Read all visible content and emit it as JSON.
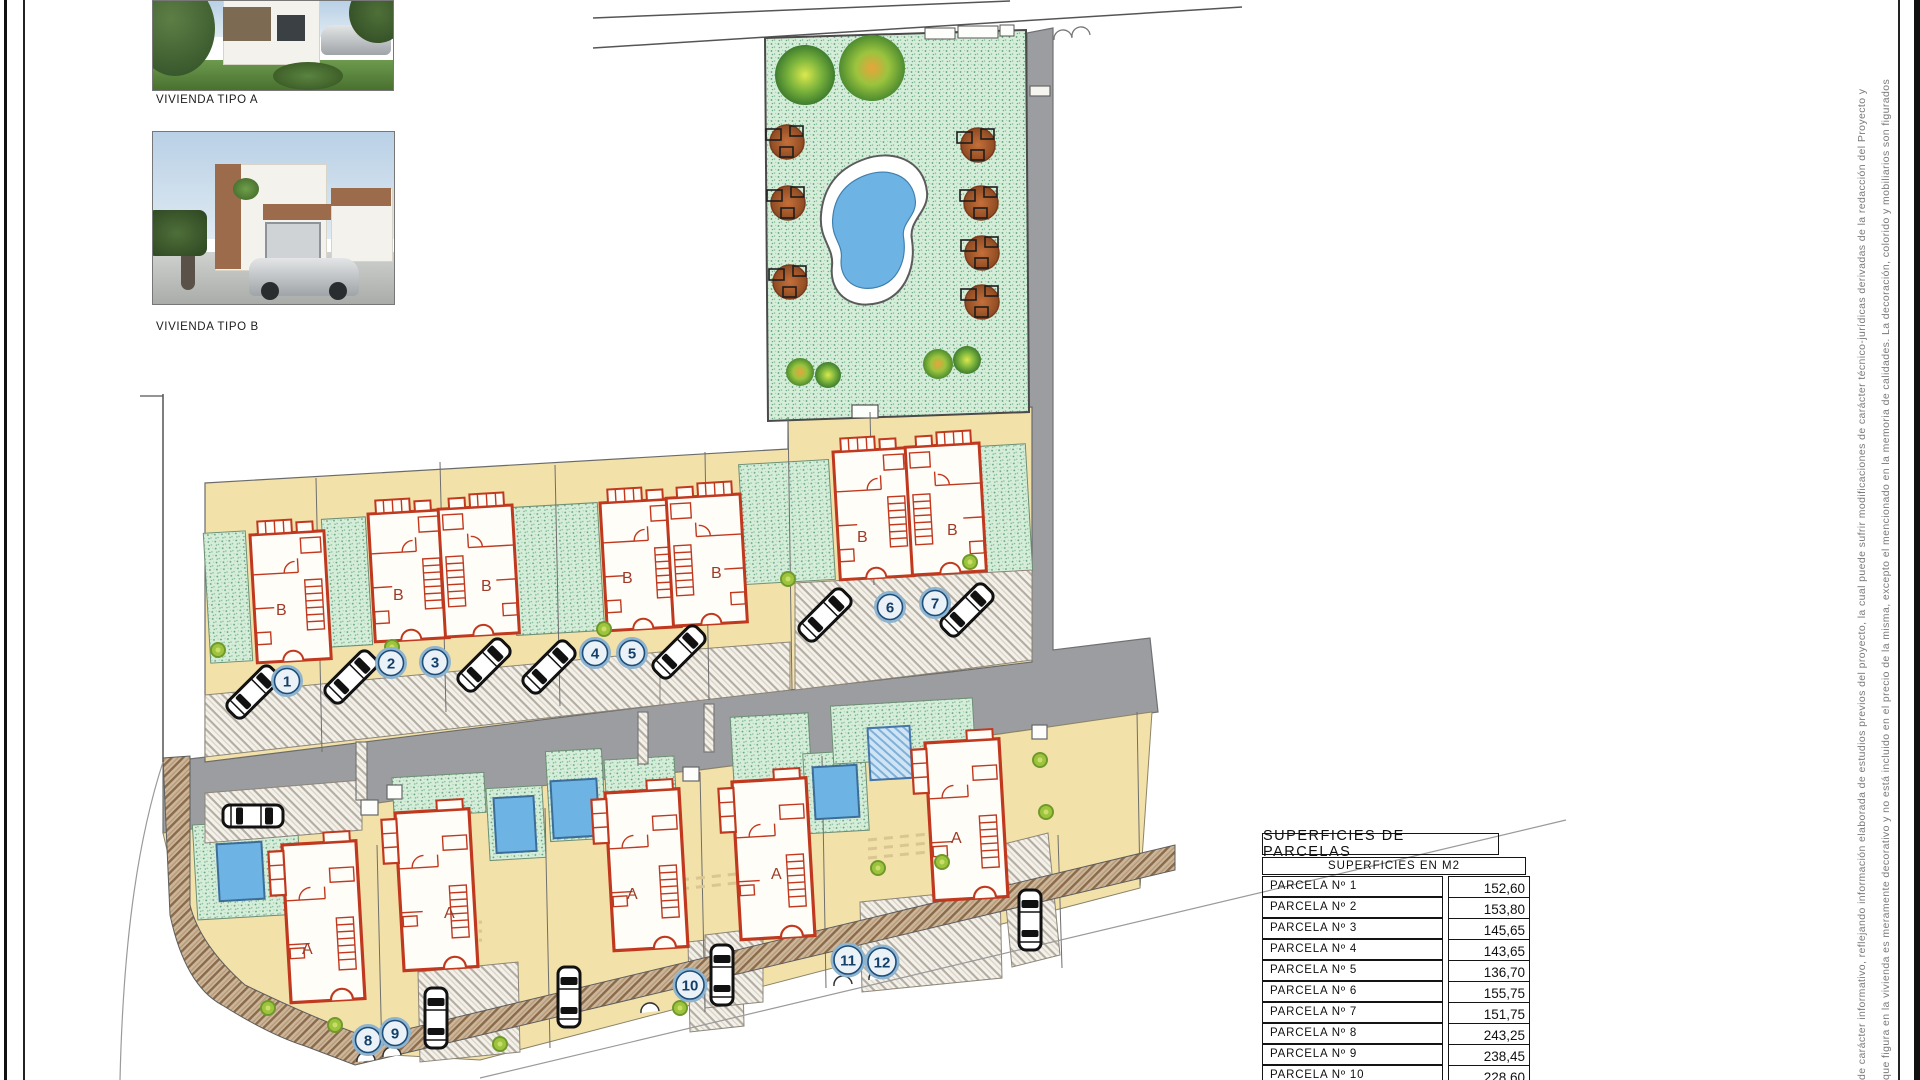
{
  "reference_images": {
    "label_a": "VIVIENDA TIPO A",
    "label_b": "VIVIENDA TIPO B"
  },
  "site_plan": {
    "parcel_markers": [
      "1",
      "2",
      "3",
      "4",
      "5",
      "6",
      "7",
      "8",
      "9",
      "10",
      "11",
      "12"
    ],
    "house_type_labels": {
      "b": [
        "B",
        "B",
        "B",
        "B",
        "B",
        "B",
        "B"
      ],
      "a": [
        "A",
        "A",
        "A",
        "A",
        "A"
      ]
    }
  },
  "areas_table": {
    "title": "SUPERFICIES  DE  PARCELAS",
    "subtitle": "SUPERFICIES  EN  M2",
    "rows": [
      {
        "label": "PARCELA  Nº  1",
        "value": "152,60"
      },
      {
        "label": "PARCELA  Nº  2",
        "value": "153,80"
      },
      {
        "label": "PARCELA  Nº  3",
        "value": "145,65"
      },
      {
        "label": "PARCELA  Nº  4",
        "value": "143,65"
      },
      {
        "label": "PARCELA  Nº  5",
        "value": "136,70"
      },
      {
        "label": "PARCELA  Nº  6",
        "value": "155,75"
      },
      {
        "label": "PARCELA  Nº  7",
        "value": "151,75"
      },
      {
        "label": "PARCELA  Nº  8",
        "value": "243,25"
      },
      {
        "label": "PARCELA  Nº  9",
        "value": "238,45"
      },
      {
        "label": "PARCELA  Nº  10",
        "value": "228,60"
      }
    ]
  },
  "sheet": {
    "disclaimer_line_1": "de carácter informativo, reflejando información elaborada de estudios previos del proyecto, la cual puede sufrir modificaciones de carácter técnico-jurídicas derivadas de la redacción del Proyecto y",
    "disclaimer_line_2": "que figura en la vivienda es meramente decorativo y no está incluido en el precio de la misma, excepto el mencionado en la memoria de calidades. La decoración, colorido y mobiliarios son figurados"
  },
  "colors": {
    "parcel_beige": "#f3e1aa",
    "garden_green": "#d6edda",
    "road_gray": "#9b9da0",
    "water_blue": "#6db4e4",
    "house_wall_red": "#c0391f",
    "marker_navy": "#143f68"
  }
}
